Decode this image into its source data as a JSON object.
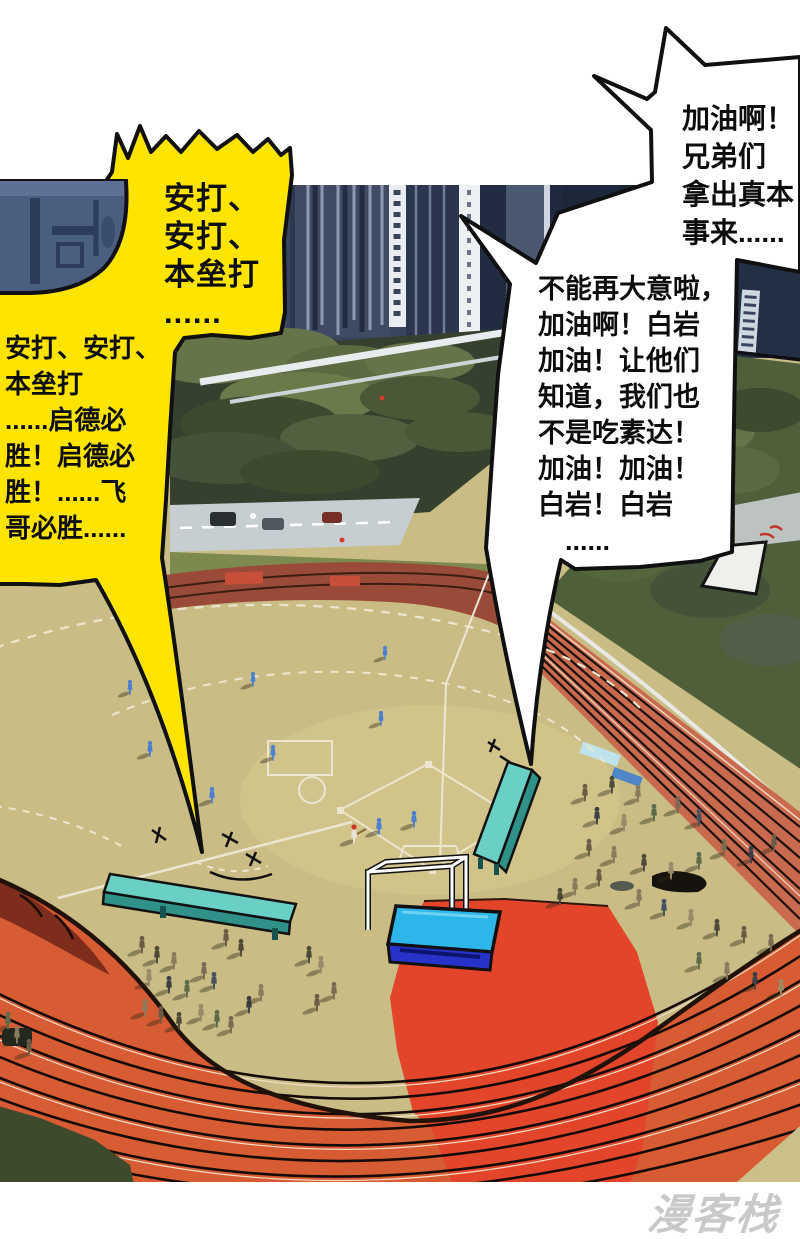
{
  "comic": {
    "bubbles": {
      "yellow_top": "安打、\n安打、\n本垒打\n......",
      "yellow_left": "安打、安打、\n本垒打\n......启德必\n胜！启德必\n胜！......飞\n哥必胜......",
      "top_right": "加油啊！\n兄弟们\n拿出真本\n事来......",
      "mid_right": "不能再大意啦，\n加油啊！白岩\n加油！让他们\n知道，我们也\n不是吃素达！\n加油！加油！\n白岩！白岩\n　......"
    },
    "watermark": "漫客栈",
    "palette": {
      "yellow_bubble": "#ffe400",
      "bubble_outline": "#101010",
      "field_tan": "#c9bd85",
      "track_orange": "#d85c33",
      "track_maroon": "#9a4a38",
      "red_carpet": "#e2452a",
      "mat_blue_top": "#2cb6e9",
      "mat_blue_front": "#2632c8",
      "bench_teal_top": "#6ad0c4",
      "bench_teal_side": "#2f9187",
      "player_blue": "#4d7fd0",
      "skyline_navy": "#1c2739",
      "trees_olive": "#55663c",
      "watermark_gray": "#c9c9c9"
    }
  }
}
